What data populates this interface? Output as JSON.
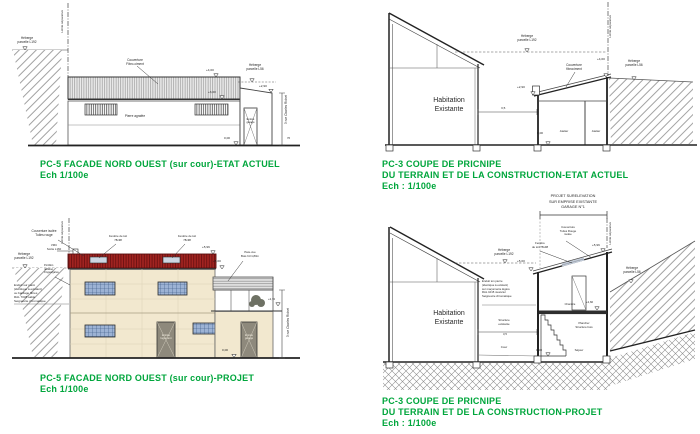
{
  "colors": {
    "title_green": "#00a63c",
    "roof_red": "#a32421",
    "wall_cream": "#f2e8cf",
    "window_blue": "#9cb2d4",
    "ink": "#333333"
  },
  "p1": {
    "title": "PC-5 FACADE NORD OUEST (sur cour)-ETAT ACTUEL",
    "scale": "Ech 1/100e",
    "limite": "Limite séparative",
    "heberge_left": "Héberge\nparcelle L192",
    "couverture": "Couverture\nFibro-ciment",
    "lvl_top": "+4,00",
    "lvl_mid": "+3,00",
    "heberge_right": "Héberge\nparcelle L56",
    "lvl_right": "+2,90",
    "wall": "Pierre agrafée",
    "lvl_zero": "0,00",
    "door": "Entrée\ngarage",
    "street": "3 rue Charles Richet",
    "dim": "76"
  },
  "p2": {
    "title1": "PC-3 COUPE DE PRICNIPE",
    "title2": "DU TERRAIN ET DE LA CONSTRUCTION-ETAT ACTUEL",
    "scale": "Ech : 1/100e",
    "house": "Habitation\nExistante",
    "heberge_mid": "Héberge\nparcelle L192",
    "limite": "Limite séparative",
    "couverture": "Couverture\nfibrociment",
    "lvl_top": "+4,00",
    "lvl_left": "+2,90",
    "heberge_right": "Héberge\nparcelle L56",
    "lvl_zero": "0,00",
    "room1": "Atelier",
    "room2": "Atelier",
    "dim": "3,5"
  },
  "p3": {
    "title": "PC-5 FACADE NORD OUEST (sur cour)-PROJET",
    "scale": "Ech 1/100e",
    "couverture": "Couverture isolée\nTuiles rouge",
    "vmc": "VMC\nSortie L160",
    "heberge_left": "Héberge\nparcelle L192",
    "limite": "Limite séparative",
    "roof_window1": "Fenêtre de toit\n78x98",
    "roof_window2": "Fenêtre de toit\n78x98",
    "lvl_top": "+5,96",
    "lvl_mid": "+5,00",
    "parevue": "Pare-vue\nBois ht=1,80m",
    "lvl_right": "+2,72",
    "enduit": "Enduit sur paroi\n(identique à existant)\nou bardage fibres\nRAL 7038 sable\nSeigneurie chromatique",
    "metal": "Portillon\nréutilisé\nzingué/galva",
    "door1": "Entrée\nlogement",
    "door2": "Entrée\ngarage",
    "lvl_zero": "0,00",
    "street": "3 rue Charles Richet"
  },
  "p4": {
    "header": "PROJET SURELEVATION\nSUR EMPRISE EXISTANTE\nGARAGE N°1",
    "title1": "PC-3 COUPE DE PRICNIPE",
    "title2": "DU TERRAIN ET DE LA CONSTRUCTION-PROJET",
    "scale": "Ech : 1/100e",
    "house": "Habitation\nExistante",
    "heberge_left": "Héberge\nparcelle L192",
    "limite": "Limite séparative",
    "couverture": "Couverture\nTuiles Rouge\nisolée",
    "roof_window": "Fenêtre\nde toit 78x98",
    "lvl_top": "+5,96",
    "lvl_mid": "+5,00",
    "heberge_right": "Héberge\nparcelle L56",
    "enduit": "Enduit ton pierre\n(identique à existant)\nsur maçonnerie légère\nRAL 1015 nuancier\nSeigneurie chromatique",
    "structure": "Structure\nexistante",
    "dim": "3,5",
    "cour": "Cour",
    "lvl_zero": "0,00",
    "sejour": "Séjour",
    "chambre": "Chambre",
    "lvl_floor": "+2,60",
    "plancher": "Plancher\nStructure bois"
  }
}
